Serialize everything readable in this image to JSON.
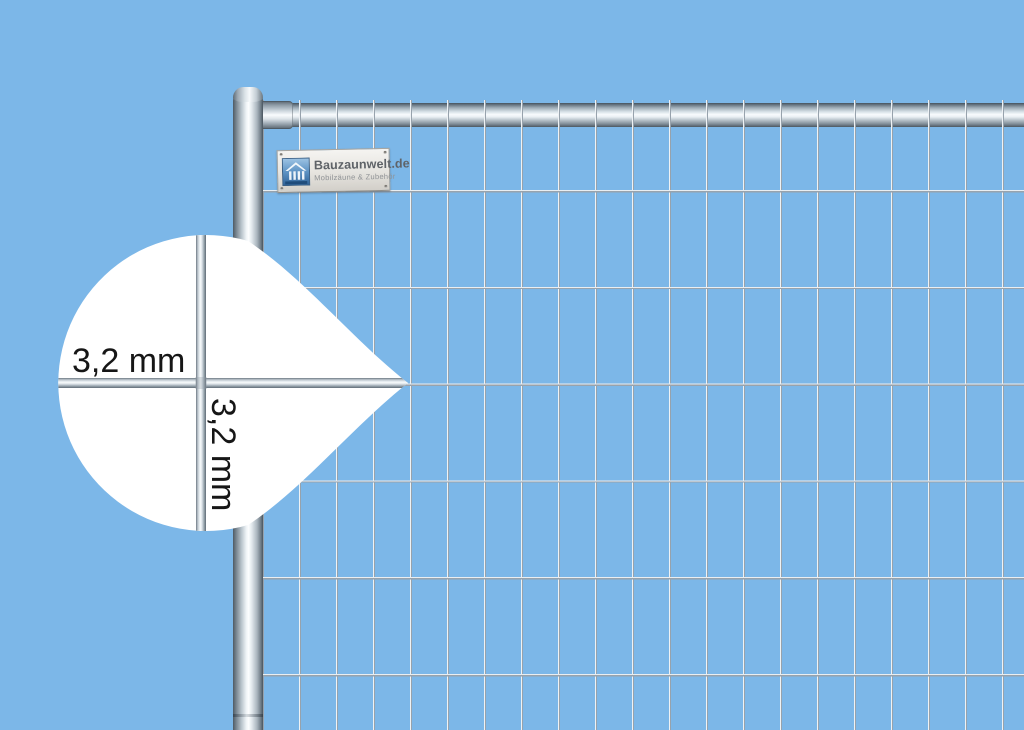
{
  "scene": {
    "type": "product-photo",
    "subject": "Mobiler Bauzaun / Gitterzaunfeld mit Drahtstaerken-Detailansicht",
    "background_color": "#7cb7e8"
  },
  "brand_label": {
    "title": "Bauzaunwelt.de",
    "subtitle": "Mobilzäune & Zubehör",
    "logo": "house-over-fence-icon"
  },
  "callout": {
    "horizontal_wire_label": "3,2 mm",
    "vertical_wire_label": "3,2 mm"
  },
  "colors": {
    "background": "#7cb7e8",
    "metal_highlight": "#f7fafb",
    "metal_shadow": "#5f6a74",
    "wire_light": "#eef2f5",
    "wire_dark": "#97a2ac",
    "callout_fill": "#ffffff",
    "callout_text": "#161616",
    "label_plate": "#e9e7e2",
    "label_text": "#5f6368",
    "logo_blue": "#4a80b4"
  }
}
